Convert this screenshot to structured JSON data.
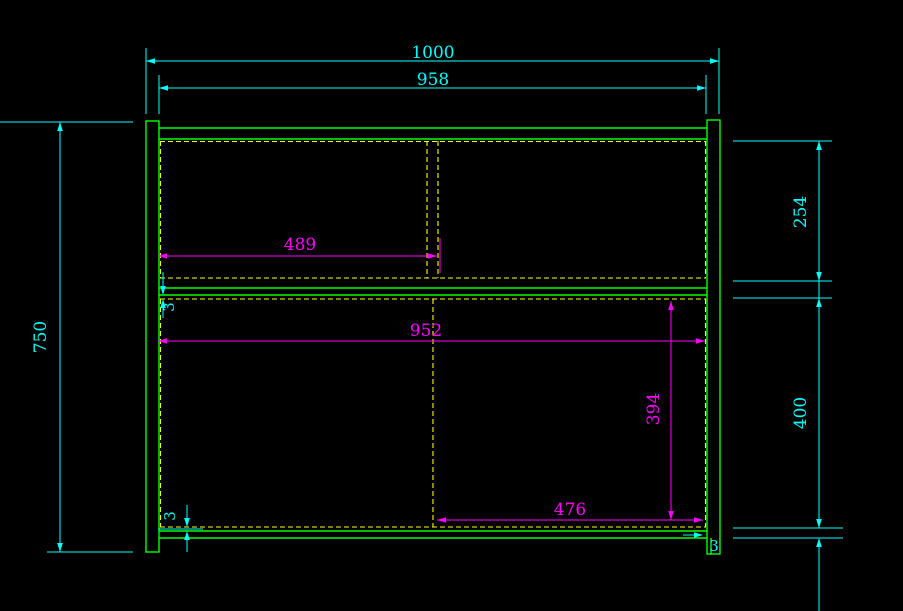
{
  "drawing": {
    "type": "cad-front-elevation",
    "background": "#000000",
    "colors": {
      "outline": "#00ff00",
      "hidden_line": "#ffff00",
      "dim_primary": "#00ffff",
      "dim_secondary": "#ff00ff"
    },
    "dims": {
      "overall_width": "1000",
      "inner_top_width": "958",
      "overall_height": "750",
      "upper_section_height": "254",
      "lower_section_height": "400",
      "upper_divider_offset": "489",
      "inner_width": "952",
      "lower_divider_height": "394",
      "lower_divider_offset": "476",
      "shelf_back_gap": "3",
      "bottom_back_gap": "3",
      "right_back_gap": "3"
    }
  }
}
